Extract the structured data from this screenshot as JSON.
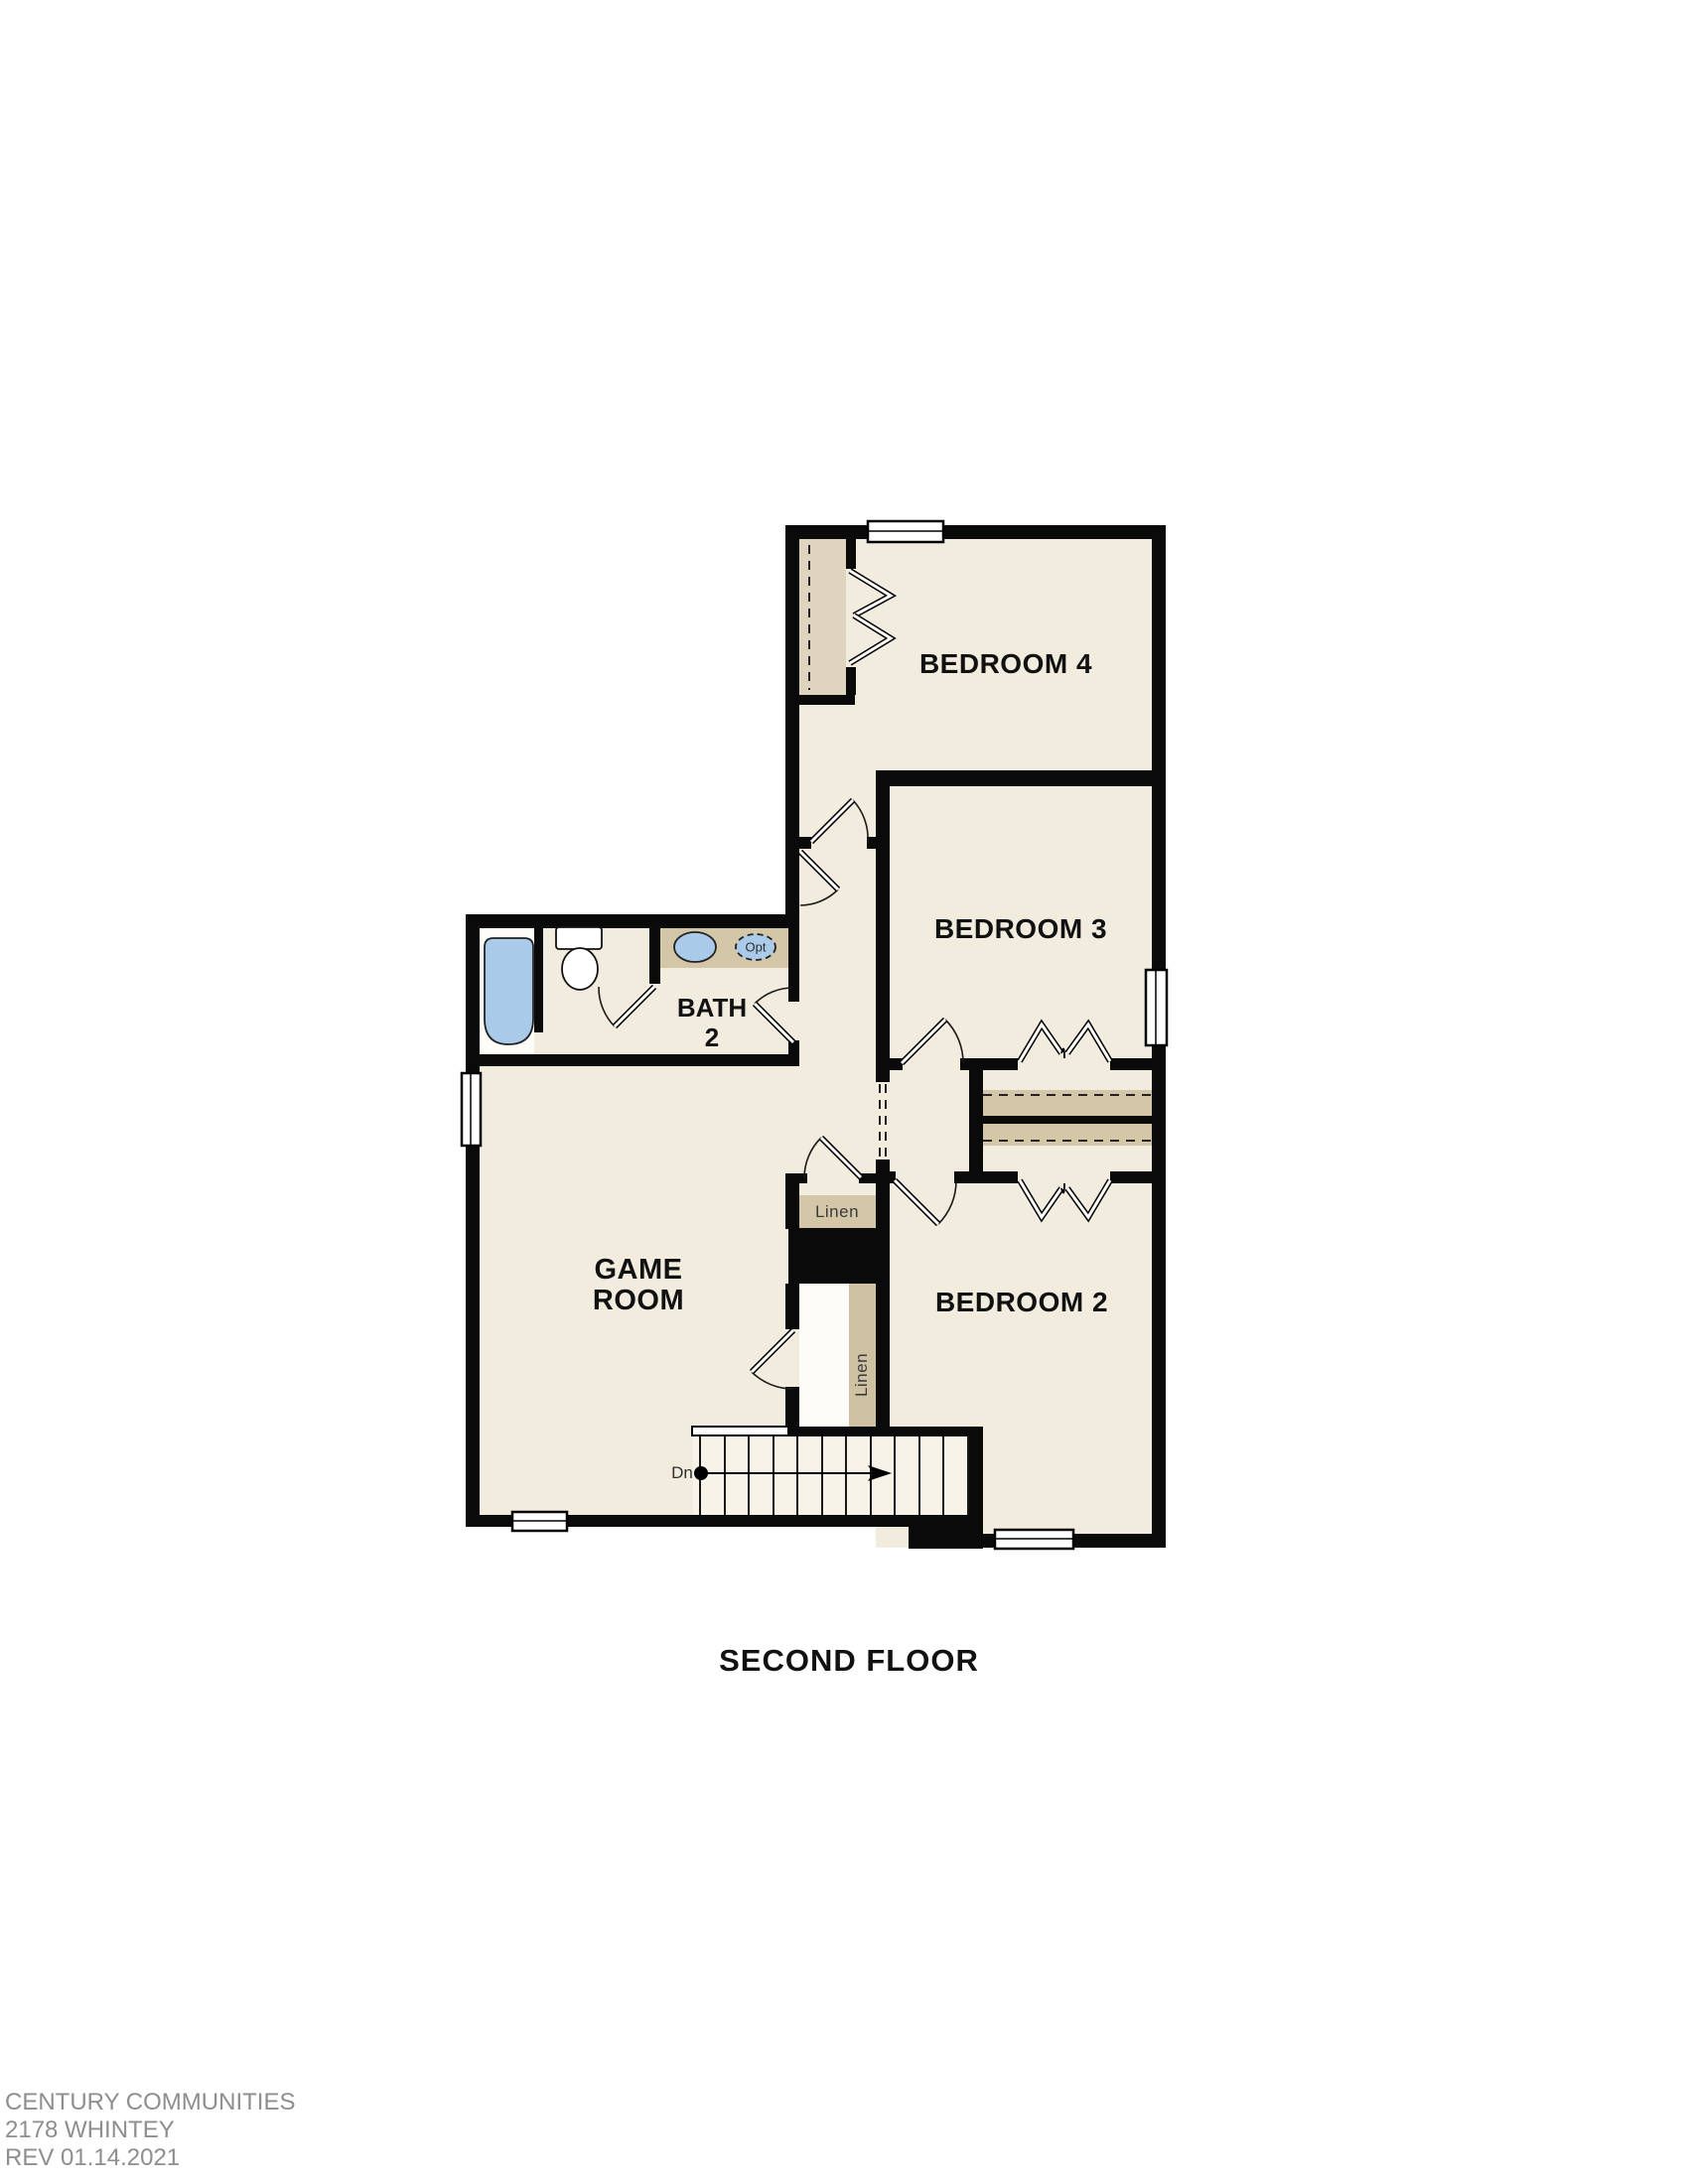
{
  "page": {
    "title": "SECOND FLOOR"
  },
  "rooms": {
    "bedroom4": "BEDROOM 4",
    "bedroom3": "BEDROOM 3",
    "bedroom2": "BEDROOM 2",
    "game_line1": "GAME",
    "game_line2": "ROOM",
    "bath_line1": "BATH",
    "bath_line2": "2"
  },
  "closets": {
    "linen_upper": "Linen",
    "linen_lower": "Linen"
  },
  "fixtures": {
    "optional_sink": "Opt"
  },
  "stairs": {
    "direction": "Dn"
  },
  "footer": {
    "company": "CENTURY COMMUNITIES",
    "plan": "2178 WHINTEY",
    "revision": "REV 01.14.2021"
  },
  "colors": {
    "floor": "#f2ecdf",
    "wall": "#0a0a0a",
    "casework_tan": "#d4c7a7",
    "closet_tan": "#ded4c0",
    "shelf_tan": "#cfc2a2",
    "fixture_blue": "#a9cbe9",
    "stair_floor": "#f7f3e9",
    "footer_gray": "#8e8e8e",
    "label_black": "#111111",
    "linen_text": "#3a3a3a"
  }
}
